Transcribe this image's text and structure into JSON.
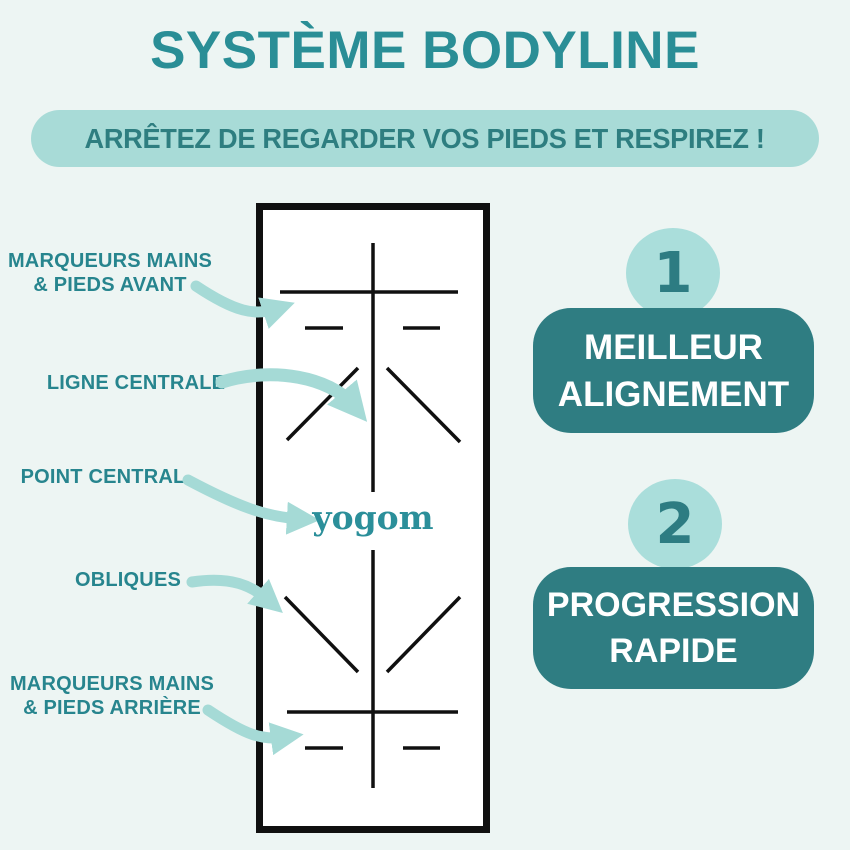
{
  "header": {
    "title": "SYSTÈME BODYLINE",
    "tagline": "ARRÊTEZ DE REGARDER VOS PIEDS ET RESPIREZ !"
  },
  "mat": {
    "logo": "yogom"
  },
  "labels": [
    {
      "name": "marqueurs-mains-pieds-avant",
      "lines": [
        "MARQUEURS MAINS",
        "& PIEDS AVANT"
      ]
    },
    {
      "name": "ligne-centrale",
      "lines": [
        "LIGNE CENTRALE"
      ]
    },
    {
      "name": "point-central",
      "lines": [
        "POINT CENTRAL"
      ]
    },
    {
      "name": "obliques",
      "lines": [
        "OBLIQUES"
      ]
    },
    {
      "name": "marqueurs-mains-pieds-arriere",
      "lines": [
        "MARQUEURS MAINS",
        "& PIEDS ARRIÈRE"
      ]
    }
  ],
  "benefits": [
    {
      "number": "1",
      "lines": [
        "MEILLEUR",
        "ALIGNEMENT"
      ]
    },
    {
      "number": "2",
      "lines": [
        "PROGRESSION",
        "RAPIDE"
      ]
    }
  ],
  "colors": {
    "background": "#edf5f3",
    "teal_text": "#2a8e96",
    "light_teal": "#a8dbd7",
    "arrow_teal": "#a5dad6",
    "badge_dark_teal": "#2f7d82",
    "badge_text": "#ffffff",
    "mat_line_black": "#101010",
    "mat_background": "#ffffff"
  }
}
